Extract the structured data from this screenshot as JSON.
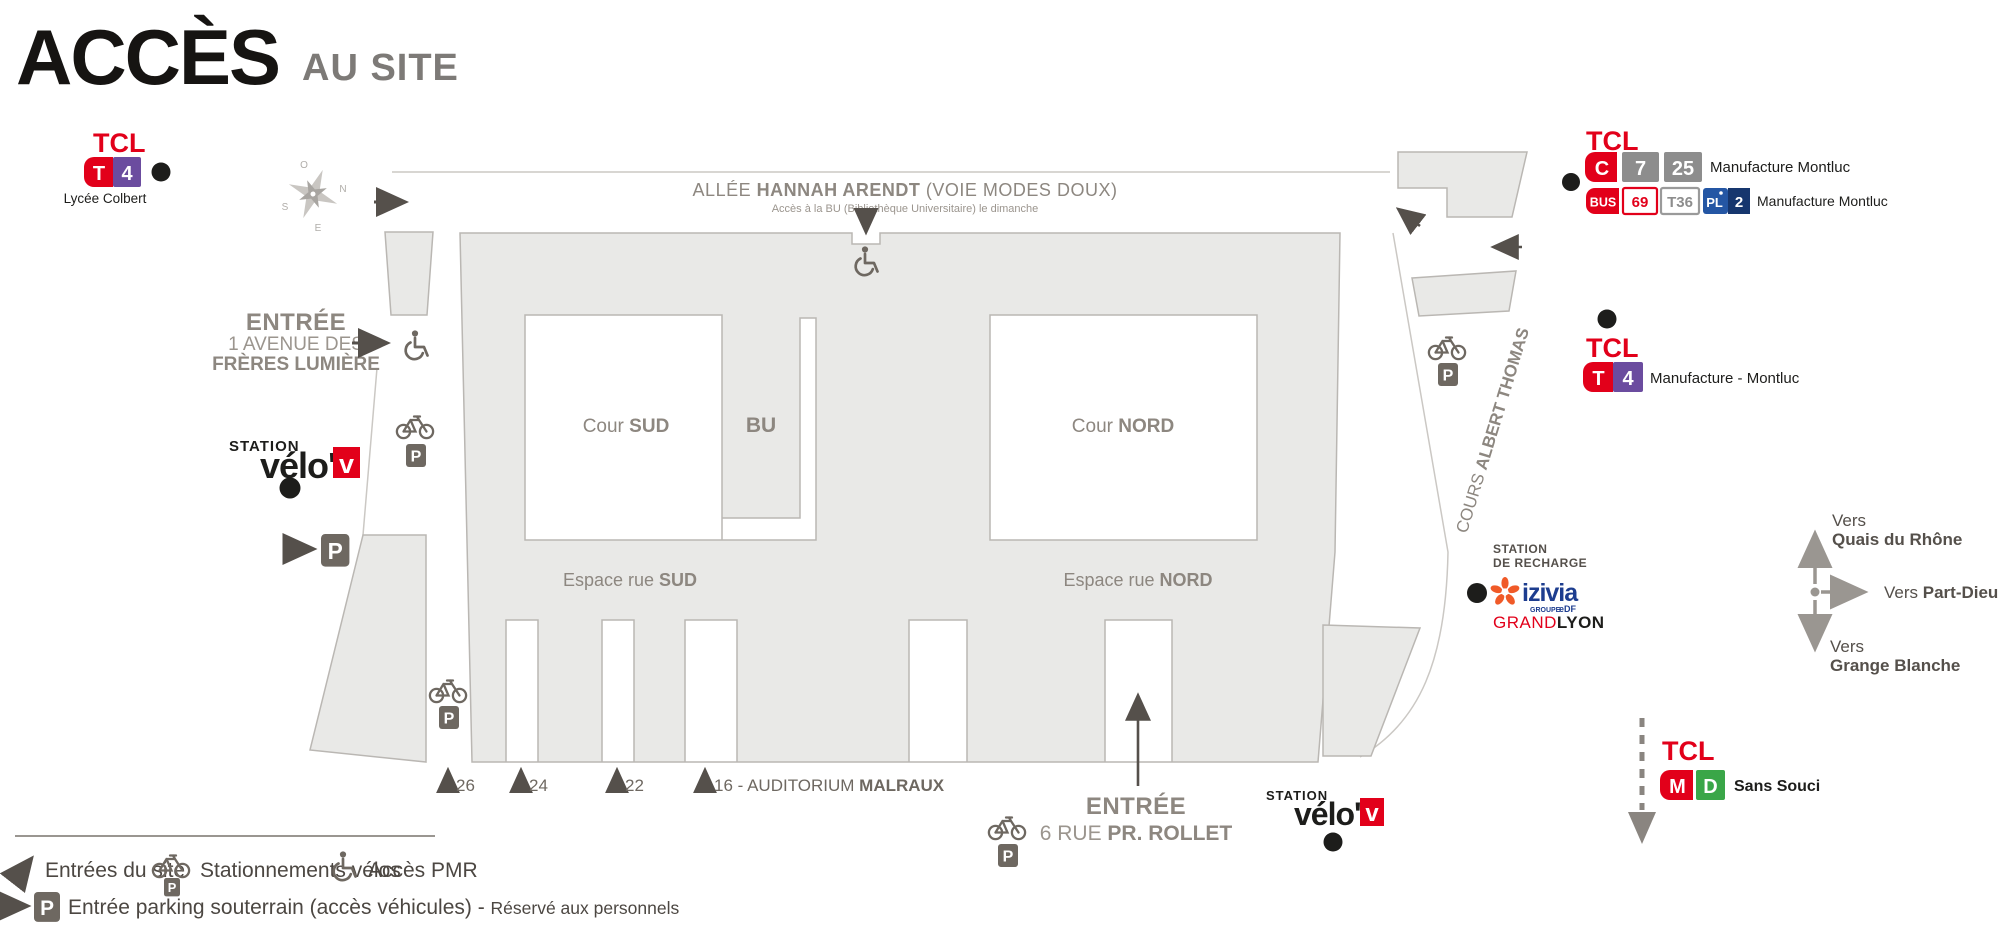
{
  "title": {
    "main": "ACCÈS",
    "sub": "AU SITE"
  },
  "parking_letter": "P",
  "compass": {
    "n": "N",
    "o": "O",
    "s": "S",
    "e": "E"
  },
  "tcl_lycee": {
    "brand": "TCL",
    "badge_t": "T",
    "badge_4": "4",
    "station": "Lycée Colbert"
  },
  "tcl_top_right": {
    "brand": "TCL",
    "badge_c": "C",
    "badge_7": "7",
    "badge_25": "25",
    "line1_station": "Manufacture Montluc",
    "badge_bus": "BUS",
    "badge_69": "69",
    "badge_t36": "T36",
    "badge_pl": "PL",
    "badge_2": "2",
    "line2_station": "Manufacture Montluc"
  },
  "tcl_tram_east": {
    "brand": "TCL",
    "badge_t": "T",
    "badge_4": "4",
    "station": "Manufacture - Montluc"
  },
  "tcl_sans_souci": {
    "brand": "TCL",
    "badge_m": "M",
    "badge_d": "D",
    "station": "Sans Souci"
  },
  "allee": {
    "prefix": "ALLÉE ",
    "bold": "HANNAH ARENDT",
    "suffix": " (VOIE MODES DOUX)",
    "note": "Accès à la BU (Bibliothèque Universitaire) le dimanche"
  },
  "cours_albert_thomas": {
    "prefix": "COURS ",
    "bold": "ALBERT THOMAS"
  },
  "entree_lumiere": {
    "title": "ENTRÉE",
    "line1": "1 AVENUE DES",
    "line2": "FRÈRES LUMIÈRE"
  },
  "entree_rollet": {
    "title": "ENTRÉE",
    "prefix": "6 RUE ",
    "bold": "PR. ROLLET"
  },
  "courtyards": {
    "cour_sud_prefix": "Cour ",
    "cour_sud_bold": "SUD",
    "bu": "BU",
    "cour_nord_prefix": "Cour ",
    "cour_nord_bold": "NORD",
    "espace_sud_prefix": "Espace rue ",
    "espace_sud_bold": "SUD",
    "espace_nord_prefix": "Espace rue ",
    "espace_nord_bold": "NORD"
  },
  "velov_west": {
    "station": "STATION",
    "brand": "vélo'",
    "v": "v"
  },
  "velov_south": {
    "station": "STATION",
    "brand": "vélo'",
    "v": "v"
  },
  "recharge": {
    "line1": "STATION",
    "line2": "DE RECHARGE",
    "izivia": "izivia",
    "groupe": "GROUPE",
    "edf": "eDF",
    "grand": "GRAND",
    "lyon": "LYON"
  },
  "directions": {
    "up_prefix": "Vers",
    "up_bold": "Quais du Rhône",
    "right_prefix": "Vers ",
    "right_bold": "Part-Dieu",
    "down_prefix": "Vers",
    "down_bold": "Grange Blanche"
  },
  "entrances": {
    "e26": "26",
    "e24": "24",
    "e22": "22",
    "e16_prefix": "16 - AUDITORIUM ",
    "e16_bold": "MALRAUX"
  },
  "legend": {
    "entrances": "Entrées du site",
    "bikes": "Stationnements vélos",
    "pmr": "Accès PMR",
    "parking_prefix": "Entrée parking souterrain (accès véhicules) - ",
    "parking_note": "Réservé aux personnels"
  },
  "colors": {
    "red": "#e2001a",
    "purple": "#6b4c9f",
    "gray_badge": "#8d8d8d",
    "green": "#3aa648",
    "blue": "#2456a4",
    "blue_dark": "#16366e",
    "orange": "#f05a28",
    "izivia_blue": "#1d3d8f",
    "ink": "#1d1d1b",
    "building": "#e9e9e7",
    "building_line": "#bab7b3",
    "map_gray": "#8d8780",
    "icon_gray": "#6e6861",
    "arrow_dark": "#55504b",
    "dir_gray": "#9a9691"
  }
}
